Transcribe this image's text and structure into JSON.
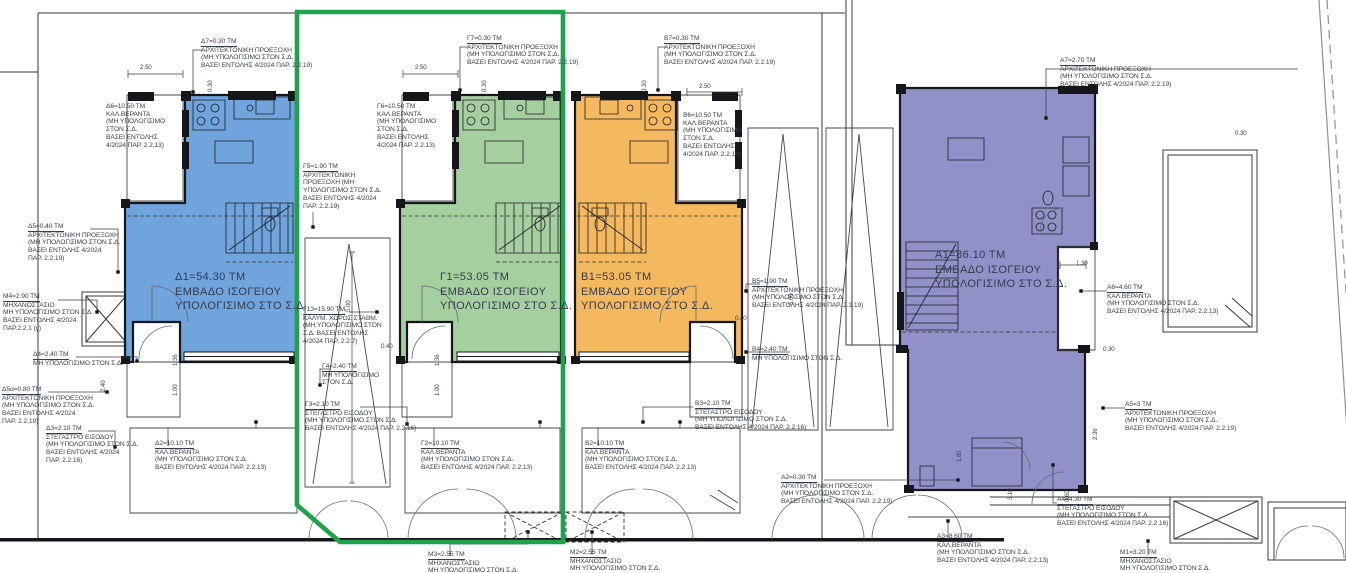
{
  "colors": {
    "unit_d_blue": "#6FA5DC",
    "unit_g_green": "#A6CFA0",
    "unit_b_orange": "#F4B95E",
    "unit_a_purple": "#9191C8",
    "highlight_green": "#1EA24C",
    "wall_black": "#15171b",
    "line_gray": "#34383f",
    "text_dark": "#383f4c"
  },
  "annotations": [
    {
      "name": "label-d7",
      "type": "label",
      "x": 201,
      "y": 38,
      "u": true,
      "leader": [
        [
          203,
          50
        ],
        [
          193,
          50
        ],
        [
          193,
          92
        ]
      ],
      "lines": [
        "Δ7=0.30 ΤΜ",
        "ΑΡΧΙΤΕΚΤΟΝΙΚΗ ΠΡΟΕΞΟΧΗ",
        "(ΜΗ ΥΠΟΛΟΓΙΣΙΜΟ ΣΤΟΝ Σ.Δ.",
        "ΒΑΣΕΙ ΕΝΤΟΛΗΣ 4/2024 ΠΑΡ. 2.2.19)"
      ]
    },
    {
      "name": "label-d6",
      "type": "label",
      "x": 106,
      "y": 103,
      "u": false,
      "lines": [
        "Δ6=10.50 ΤΜ",
        "ΚΑΛ.ΒΕΡΑΝΤΑ",
        "(ΜΗ ΥΠΟΛΟΓΙΣΙΜΟ",
        "ΣΤΟΝ Σ.Δ.",
        "ΒΑΣΕΙ ΕΝΤΟΛΗΣ",
        "4/2024 ΠΑΡ. 2.2.13)"
      ]
    },
    {
      "name": "label-d1",
      "type": "big",
      "x": 175,
      "y": 270,
      "lines": [
        "Δ1=54.30 ΤΜ",
        "ΕΜΒΑΔΟ ΙΣΟΓΕΙΟΥ",
        "ΥΠΟΛΟΓΙΣΙΜΟ ΣΤΟ Σ.Δ."
      ]
    },
    {
      "name": "label-d5",
      "type": "label",
      "x": 28,
      "y": 223,
      "u": true,
      "leader": [
        [
          90,
          229
        ],
        [
          118,
          229
        ],
        [
          118,
          272
        ]
      ],
      "lines": [
        "Δ5=0.40 ΤΜ",
        "ΑΡΧΙΤΕΚΤΟΝΙΚΗ ΠΡΟΕΞΟΧΗ",
        "(ΜΗ ΥΠΟΛΟΓΙΣΙΜΟ ΣΤΟΝ Σ.Δ.",
        "ΒΑΣΕΙ ΕΝΤΟΛΗΣ 4/2024",
        "ΠΑΡ. 2.2.19)"
      ]
    },
    {
      "name": "label-m4",
      "type": "label",
      "x": 3,
      "y": 293,
      "u": true,
      "leader": [
        [
          58,
          300
        ],
        [
          97,
          300
        ],
        [
          97,
          312
        ]
      ],
      "lines": [
        "Μ4=2.90 ΤΜ",
        "ΜΗΧΑΝΟΣΤΑΣΙΟ",
        "ΜΗ ΥΠΟΛΟΓΙΣΙΜΟ ΣΤΟΝ Σ.Δ.",
        "ΒΑΣΕΙ ΕΝΤΟΛΗΣ 4/2024",
        "ΠΑΡ.2.2.1 (γ)"
      ]
    },
    {
      "name": "label-d4",
      "type": "label",
      "x": 33,
      "y": 351,
      "u": true,
      "leader": [
        [
          76,
          357
        ],
        [
          137,
          357
        ],
        [
          137,
          361
        ]
      ],
      "lines": [
        "Δ4=2.40 ΤΜ",
        "ΜΗ ΥΠΟΛΟΓΙΣΙΜΟ ΣΤΟΝ Σ.Δ."
      ]
    },
    {
      "name": "label-d5a",
      "type": "label",
      "x": 2,
      "y": 386,
      "u": true,
      "leader": [
        [
          48,
          392
        ],
        [
          107,
          392
        ]
      ],
      "lines": [
        "Δ5α=0.80 ΤΜ",
        "ΑΡΧΙΤΕΚΤΟΝΙΚΗ ΠΡΟΕΞΟΧΗ",
        "(ΜΗ ΥΠΟΛΟΓΙΣΙΜΟ ΣΤΟΝ Σ.Δ.",
        "ΒΑΣΕΙ ΕΝΤΟΛΗΣ 4/2024",
        "ΠΑΡ. 2.2.19)"
      ]
    },
    {
      "name": "label-d3",
      "type": "label",
      "x": 46,
      "y": 425,
      "u": true,
      "leader": [
        [
          88,
          431
        ],
        [
          115,
          431
        ],
        [
          115,
          447
        ]
      ],
      "lines": [
        "Δ3=2.10 ΤΜ",
        "ΣΤΕΓΑΣΤΡΟ ΕΙΣΟΔΟΥ",
        "(ΜΗ ΥΠΟΛΟΓΙΣΙΜΟ ΣΤΟΝ Σ.Δ.",
        "ΒΑΣΕΙ ΕΝΤΟΛΗΣ 4/2024",
        "ΠΑΡ. 2.2.16)"
      ]
    },
    {
      "name": "label-d2",
      "type": "label",
      "x": 155,
      "y": 440,
      "u": true,
      "leader": [
        [
          168,
          446
        ],
        [
          168,
          428
        ],
        [
          256,
          428
        ],
        [
          256,
          422
        ]
      ],
      "lines": [
        "Δ2=10.10 ΤΜ",
        "ΚΑΛ.ΒΕΡΑΝΤΑ",
        "(ΜΗ ΥΠΟΛΟΓΙΣΙΜΟ ΣΤΟΝ Σ.Δ.",
        "ΒΑΣΕΙ ΕΝΤΟΛΗΣ 4/2024 ΠΑΡ. 2.2.13)"
      ]
    },
    {
      "name": "label-g7",
      "type": "label",
      "x": 467,
      "y": 35,
      "u": true,
      "leader": [
        [
          469,
          47
        ],
        [
          460,
          47
        ],
        [
          460,
          90
        ]
      ],
      "lines": [
        "Γ7=0.30 ΤΜ",
        "ΑΡΧΙΤΕΚΤΟΝΙΚΗ ΠΡΟΕΞΟΧΗ",
        "(ΜΗ ΥΠΟΛΟΓΙΣΙΜΟ ΣΤΟΝ Σ.Δ.",
        "ΒΑΣΕΙ ΕΝΤΟΛΗΣ 4/2024 ΠΑΡ. 2.2.19)"
      ]
    },
    {
      "name": "label-g6",
      "type": "label",
      "x": 377,
      "y": 103,
      "u": false,
      "lines": [
        "Γ6=10.50 ΤΜ",
        "ΚΑΛ.ΒΕΡΑΝΤΑ",
        "(ΜΗ ΥΠΟΛΟΓΙΣΙΜΟ",
        "ΣΤΟΝ Σ.Δ.",
        "ΒΑΣΕΙ ΕΝΤΟΛΗΣ",
        "4/2024 ΠΑΡ. 2.2.13)"
      ]
    },
    {
      "name": "label-g5",
      "type": "label",
      "x": 303,
      "y": 163,
      "u": true,
      "leader": [
        [
          313,
          212
        ],
        [
          313,
          227
        ]
      ],
      "lines": [
        "Γ5=1.90 ΤΜ",
        "ΑΡΧΙΤΕΚΤΟΝΙΚΗ",
        "ΠΡΟΕΞΟΧΗ (ΜΗ",
        "ΥΠΟΛΟΓΙΣΙΜΟ ΣΤΟΝ Σ.Δ.",
        "ΒΑΣΕΙ ΕΝΤΟΛΗΣ 4/2024",
        "ΠΑΡ. 2.2.19)"
      ]
    },
    {
      "name": "label-g1",
      "type": "big",
      "x": 440,
      "y": 270,
      "lines": [
        "Γ1=53.05 ΤΜ",
        "ΕΜΒΑΔΟ ΙΣΟΓΕΙΟΥ",
        "ΥΠΟΛΟΓΙΣΙΜΟ ΣΤΟ Σ.Δ."
      ]
    },
    {
      "name": "label-g13",
      "type": "label",
      "x": 303,
      "y": 306,
      "u": true,
      "leader": [
        [
          349,
          312
        ],
        [
          377,
          312
        ]
      ],
      "lines": [
        "Γ13=15.90 ΤΜ",
        "ΚΑΛΥΜ. ΧΩΡΟΣ ΣΤΑΘΜ.",
        "(ΜΗ ΥΠΟΛΟΓΙΣΙΜΟ ΣΤΟΝ",
        "Σ.Δ. ΒΑΣΕΙ ΕΝΤΟΛΗΣ",
        "4/2024 ΠΑΡ. 2.2.7)"
      ]
    },
    {
      "name": "label-g4",
      "type": "label",
      "x": 322,
      "y": 363,
      "u": true,
      "leader": [
        [
          330,
          369
        ],
        [
          320,
          369
        ],
        [
          320,
          385
        ]
      ],
      "lines": [
        "Γ4=2.40 ΤΜ",
        "ΜΗ ΥΠΟΛΟΓΙΣΙΜΟ",
        "ΣΤΟΝ Σ.Δ."
      ]
    },
    {
      "name": "label-g3",
      "type": "label",
      "x": 305,
      "y": 401,
      "u": true,
      "leader": [
        [
          360,
          407
        ],
        [
          407,
          407
        ],
        [
          407,
          424
        ]
      ],
      "lines": [
        "Γ3=2.10 ΤΜ",
        "ΣΤΕΓΑΣΤΡΟ ΕΙΣΟΔΟΥ",
        "(ΜΗ ΥΠΟΛΟΓΙΣΙΜΟ ΣΤΟΝ Σ.Δ.",
        "ΒΑΣΕΙ ΕΝΤΟΛΗΣ 4/2024 ΠΑΡ. 2.2.16)"
      ]
    },
    {
      "name": "label-g2",
      "type": "label",
      "x": 421,
      "y": 440,
      "u": true,
      "leader": [
        [
          434,
          446
        ],
        [
          434,
          428
        ],
        [
          540,
          428
        ],
        [
          540,
          422
        ]
      ],
      "lines": [
        "Γ2=10.10 ΤΜ",
        "ΚΑΛ.ΒΕΡΑΝΤΑ",
        "(ΜΗ ΥΠΟΛΟΓΙΣΙΜΟ ΣΤΟΝ Σ.Δ.",
        "ΒΑΣΕΙ ΕΝΤΟΛΗΣ 4/2024 ΠΑΡ. 2.2.13)"
      ]
    },
    {
      "name": "label-b7",
      "type": "label",
      "x": 664,
      "y": 35,
      "u": true,
      "leader": [
        [
          666,
          47
        ],
        [
          658,
          47
        ],
        [
          658,
          90
        ]
      ],
      "lines": [
        "Β7=0.30 ΤΜ",
        "ΑΡΧΙΤΕΚΤΟΝΙΚΗ ΠΡΟΕΞΟΧΗ",
        "(ΜΗ ΥΠΟΛΟΓΙΣΙΜΟ ΣΤΟΝ Σ.Δ.",
        "ΒΑΣΕΙ ΕΝΤΟΛΗΣ 4/2024 ΠΑΡ. 2.2.19)"
      ]
    },
    {
      "name": "label-b6",
      "type": "label",
      "x": 683,
      "y": 112,
      "u": false,
      "lines": [
        "Β6=10.50 ΤΜ",
        "ΚΑΛ.ΒΕΡΑΝΤΑ",
        "(ΜΗ ΥΠΟΛΟΓΙΣΙΜΟ",
        "ΣΤΟΝ Σ.Δ.",
        "ΒΑΣΕΙ ΕΝΤΟΛΗΣ",
        "4/2024 ΠΑΡ. 2.2.13)"
      ]
    },
    {
      "name": "label-b1",
      "type": "big",
      "x": 581,
      "y": 270,
      "lines": [
        "Β1=53.05 ΤΜ",
        "ΕΜΒΑΔΟ ΙΣΟΓΕΙΟΥ",
        "ΥΠΟΛΟΓΙΣΙΜΟ ΣΤΟ Σ.Δ."
      ]
    },
    {
      "name": "label-b5",
      "type": "label",
      "x": 752,
      "y": 278,
      "u": true,
      "leader": [
        [
          760,
          284
        ],
        [
          746,
          284
        ],
        [
          746,
          291
        ]
      ],
      "lines": [
        "Β5=1.90 ΤΜ",
        "ΑΡΧΙΤΕΚΤΟΝΙΚΗ ΠΡΟΕΞΟΧΗ",
        "(ΜΗ ΥΠΟΛΟΓΙΣΙΜΟ ΣΤΟΝ Σ.Δ.",
        "ΒΑΣΕΙ ΕΝΤΟΛΗΣ 4/2024 ΠΑΡ. 2.2.19)"
      ]
    },
    {
      "name": "label-b4",
      "type": "label",
      "x": 752,
      "y": 346,
      "u": true,
      "leader": [
        [
          790,
          352
        ],
        [
          746,
          352
        ]
      ],
      "lines": [
        "Β4=2.40 ΤΜ",
        "ΜΗ ΥΠΟΛΟΓΙΣΙΜΟ ΣΤΟΝ Σ.Δ."
      ]
    },
    {
      "name": "label-b3",
      "type": "label",
      "x": 695,
      "y": 400,
      "u": true,
      "leader": [
        [
          693,
          407
        ],
        [
          643,
          407
        ],
        [
          643,
          422
        ]
      ],
      "lines": [
        "Β3=2.10 ΤΜ",
        "ΣΤΕΓΑΣΤΡΟ ΕΙΣΟΔΟΥ",
        "(ΜΗ ΥΠΟΛΟΓΙΣΙΜΟ ΣΤΟΝ Σ.Δ.",
        "ΒΑΣΕΙ ΕΝΤΟΛΗΣ 4/2024 ΠΑΡ. 2.2.16)"
      ]
    },
    {
      "name": "label-b2",
      "type": "label",
      "x": 585,
      "y": 440,
      "u": true,
      "leader": [
        [
          598,
          446
        ],
        [
          598,
          428
        ],
        [
          680,
          428
        ],
        [
          680,
          422
        ]
      ],
      "lines": [
        "Β2=10.10 ΤΜ",
        "ΚΑΛ.ΒΕΡΑΝΤΑ",
        "(ΜΗ ΥΠΟΛΟΓΙΣΙΜΟ ΣΤΟΝ Σ.Δ.",
        "ΒΑΣΕΙ ΕΝΤΟΛΗΣ 4/2024 ΠΑΡ. 2.2.13)"
      ]
    },
    {
      "name": "label-a2",
      "type": "label",
      "x": 781,
      "y": 474,
      "u": true,
      "leader": [
        [
          824,
          480
        ],
        [
          958,
          480
        ]
      ],
      "lines": [
        "Α2=0.30 ΤΜ",
        "ΑΡΧΙΤΕΚΤΟΝΙΚΗ ΠΡΟΕΞΟΧΗ",
        "(ΜΗ ΥΠΟΛΟΓΙΣΙΜΟ ΣΤΟΝ Σ.Δ.",
        "ΒΑΣΕΙ ΕΝΤΟΛΗΣ 4/2024 ΠΑΡ. 2.2.19)"
      ]
    },
    {
      "name": "label-a7",
      "type": "label",
      "x": 1060,
      "y": 57,
      "u": true,
      "leader": [
        [
          1298,
          69
        ],
        [
          1046,
          69
        ],
        [
          1046,
          118
        ]
      ],
      "lines": [
        "Α7=2.70 ΤΜ",
        "ΑΡΧΙΤΕΚΤΟΝΙΚΗ ΠΡΟΕΞΟΧΗ",
        "(ΜΗ ΥΠΟΛΟΓΙΣΙΜΟ ΣΤΟΝ Σ.Δ.",
        "ΒΑΣΕΙ ΕΝΤΟΛΗΣ 4/2024 ΠΑΡ. 2.2.19)"
      ]
    },
    {
      "name": "label-a1",
      "type": "big",
      "x": 935,
      "y": 248,
      "lines": [
        "Α1=86.10 ΤΜ",
        "ΕΜΒΑΔΟ ΙΣΟΓΕΙΟΥ",
        "ΥΠΟΛΟΓΙΣΙΜΟ ΣΤΟ Σ.Δ."
      ]
    },
    {
      "name": "label-a6",
      "type": "label",
      "x": 1107,
      "y": 284,
      "u": true,
      "leader": [
        [
          1107,
          291
        ],
        [
          1081,
          291
        ]
      ],
      "lines": [
        "Α6=4.60 ΤΜ",
        "ΚΑΛ.ΒΕΡΑΝΤΑ",
        "(ΜΗ ΥΠΟΛΟΓΙΣΙΜΟ ΣΤΟΝ Σ.Δ.",
        "ΒΑΣΕΙ ΕΝΤΟΛΗΣ 4/2024 ΠΑΡ. 2.2.13)"
      ]
    },
    {
      "name": "label-a5",
      "type": "label",
      "x": 1125,
      "y": 401,
      "u": true,
      "leader": [
        [
          1125,
          408
        ],
        [
          1103,
          408
        ]
      ],
      "lines": [
        "Α5=3 ΤΜ",
        "ΑΡΧΙΤΕΚΤΟΝΙΚΗ ΠΡΟΕΞΟΧΗ",
        "(ΜΗ ΥΠΟΛΟΓΙΣΙΜΟ ΣΤΟΝ Σ.Δ.",
        "ΒΑΣΕΙ ΕΝΤΟΛΗΣ 4/2024 ΠΑΡ. 2.2.19)"
      ]
    },
    {
      "name": "label-a4",
      "type": "label",
      "x": 1057,
      "y": 496,
      "u": true,
      "leader": [
        [
          1057,
          503
        ],
        [
          1053,
          503
        ],
        [
          1053,
          465
        ]
      ],
      "lines": [
        "Α4=4.30 ΤΜ",
        "ΣΤΕΓΑΣΤΡΟ ΕΙΣΟΔΟΥ",
        "(ΜΗ ΥΠΟΛΟΓΙΣΙΜΟ ΣΤΟΝ Σ.Δ.",
        "ΒΑΣΕΙ ΕΝΤΟΛΗΣ 4/2024 ΠΑΡ. 2.2.16)"
      ]
    },
    {
      "name": "label-a3",
      "type": "label",
      "x": 937,
      "y": 533,
      "u": true,
      "leader": [
        [
          948,
          539
        ],
        [
          948,
          521
        ]
      ],
      "lines": [
        "Α3=8.60 ΤΜ",
        "ΚΑΛ.ΒΕΡΑΝΤΑ",
        "(ΜΗ ΥΠΟΛΟΓΙΣΙΜΟ ΣΤΟΝ Σ.Δ.",
        "ΒΑΣΕΙ ΕΝΤΟΛΗΣ 4/2024 ΠΑΡ. 2.2.13)"
      ]
    },
    {
      "name": "label-m1",
      "type": "label",
      "x": 1120,
      "y": 549,
      "u": true,
      "leader": [
        [
          1148,
          555
        ],
        [
          1148,
          541
        ]
      ],
      "lines": [
        "Μ1=3.20 ΤΜ",
        "ΜΗΧΑΝΟΣΤΑΣΙΟ",
        "ΜΗ ΥΠΟΛΟΓΙΣΙΜΟ ΣΤΟΝ Σ.Δ."
      ]
    },
    {
      "name": "label-m3",
      "type": "label",
      "x": 428,
      "y": 551,
      "u": true,
      "leader": [
        [
          450,
          556
        ],
        [
          450,
          544
        ],
        [
          528,
          544
        ],
        [
          528,
          532
        ]
      ],
      "lines": [
        "Μ3=2.55 ΤΜ",
        "ΜΗΧΑΝΟΣΤΑΣΙΟ",
        "ΜΗ ΥΠΟΛΟΓΙΣΙΜΟ ΣΤΟΝ Σ.Δ."
      ]
    },
    {
      "name": "label-m2",
      "type": "label",
      "x": 570,
      "y": 549,
      "u": true,
      "leader": [
        [
          592,
          555
        ],
        [
          592,
          532
        ]
      ],
      "lines": [
        "Μ2=2.55 ΤΜ",
        "ΜΗΧΑΝΟΣΤΑΣΙΟ",
        "ΜΗ ΥΠΟΛΟΓΙΣΙΜΟ ΣΤΟΝ Σ.Δ."
      ]
    },
    {
      "name": "dim-250-d",
      "type": "dim",
      "x": 140,
      "y": 64,
      "lines": [
        "2.50"
      ]
    },
    {
      "name": "dim-250-g",
      "type": "dim",
      "x": 415,
      "y": 64,
      "lines": [
        "2.50"
      ]
    },
    {
      "name": "dim-250-b",
      "type": "dim",
      "x": 699,
      "y": 83,
      "lines": [
        "2.50"
      ]
    },
    {
      "name": "dim-030-d",
      "type": "dim",
      "rot": true,
      "x": 207,
      "y": 92,
      "lines": [
        "0.30"
      ]
    },
    {
      "name": "dim-030-g",
      "type": "dim",
      "rot": true,
      "x": 481,
      "y": 92,
      "lines": [
        "0.30"
      ]
    },
    {
      "name": "dim-030-b",
      "type": "dim",
      "rot": true,
      "x": 641,
      "y": 92,
      "lines": [
        "0.30"
      ]
    },
    {
      "name": "dim-500-p1",
      "type": "dim",
      "rot": true,
      "x": 345,
      "y": 312,
      "lines": [
        "5.00"
      ]
    },
    {
      "name": "dim-500-p2",
      "type": "dim",
      "rot": true,
      "x": 788,
      "y": 305,
      "lines": [
        "5.00"
      ]
    },
    {
      "name": "dim-040-g",
      "type": "dim",
      "x": 381,
      "y": 343,
      "lines": [
        "0.40"
      ]
    },
    {
      "name": "dim-040-b",
      "type": "dim",
      "x": 735,
      "y": 315,
      "lines": [
        "0.40"
      ]
    },
    {
      "name": "dim-130-a",
      "type": "dim",
      "x": 1076,
      "y": 260,
      "lines": [
        "1.30"
      ]
    },
    {
      "name": "dim-030-a1",
      "type": "dim",
      "x": 1103,
      "y": 346,
      "lines": [
        "0.30"
      ]
    },
    {
      "name": "dim-030-a2",
      "type": "dim",
      "x": 1235,
      "y": 130,
      "lines": [
        "0.30"
      ]
    },
    {
      "name": "dim-136-d",
      "type": "dim",
      "rot": true,
      "x": 172,
      "y": 366,
      "lines": [
        "1.36"
      ]
    },
    {
      "name": "dim-100-d",
      "type": "dim",
      "rot": true,
      "x": 172,
      "y": 396,
      "lines": [
        "1.00"
      ]
    },
    {
      "name": "dim-136-g",
      "type": "dim",
      "rot": true,
      "x": 434,
      "y": 366,
      "lines": [
        "1.36"
      ]
    },
    {
      "name": "dim-100-g",
      "type": "dim",
      "rot": true,
      "x": 434,
      "y": 396,
      "lines": [
        "1.00"
      ]
    },
    {
      "name": "dim-240-d",
      "type": "dim",
      "rot": true,
      "x": 100,
      "y": 392,
      "lines": [
        "2.40"
      ]
    },
    {
      "name": "dim-185-a",
      "type": "dim",
      "rot": true,
      "x": 956,
      "y": 462,
      "lines": [
        "1.85"
      ]
    },
    {
      "name": "dim-310-a",
      "type": "dim",
      "rot": true,
      "x": 1007,
      "y": 500,
      "lines": [
        "3.10"
      ]
    },
    {
      "name": "dim-060-a",
      "type": "dim",
      "rot": true,
      "x": 1064,
      "y": 502,
      "lines": [
        "0.60"
      ]
    },
    {
      "name": "dim-236-a",
      "type": "dim",
      "rot": true,
      "x": 1092,
      "y": 440,
      "lines": [
        "2.36"
      ]
    }
  ]
}
